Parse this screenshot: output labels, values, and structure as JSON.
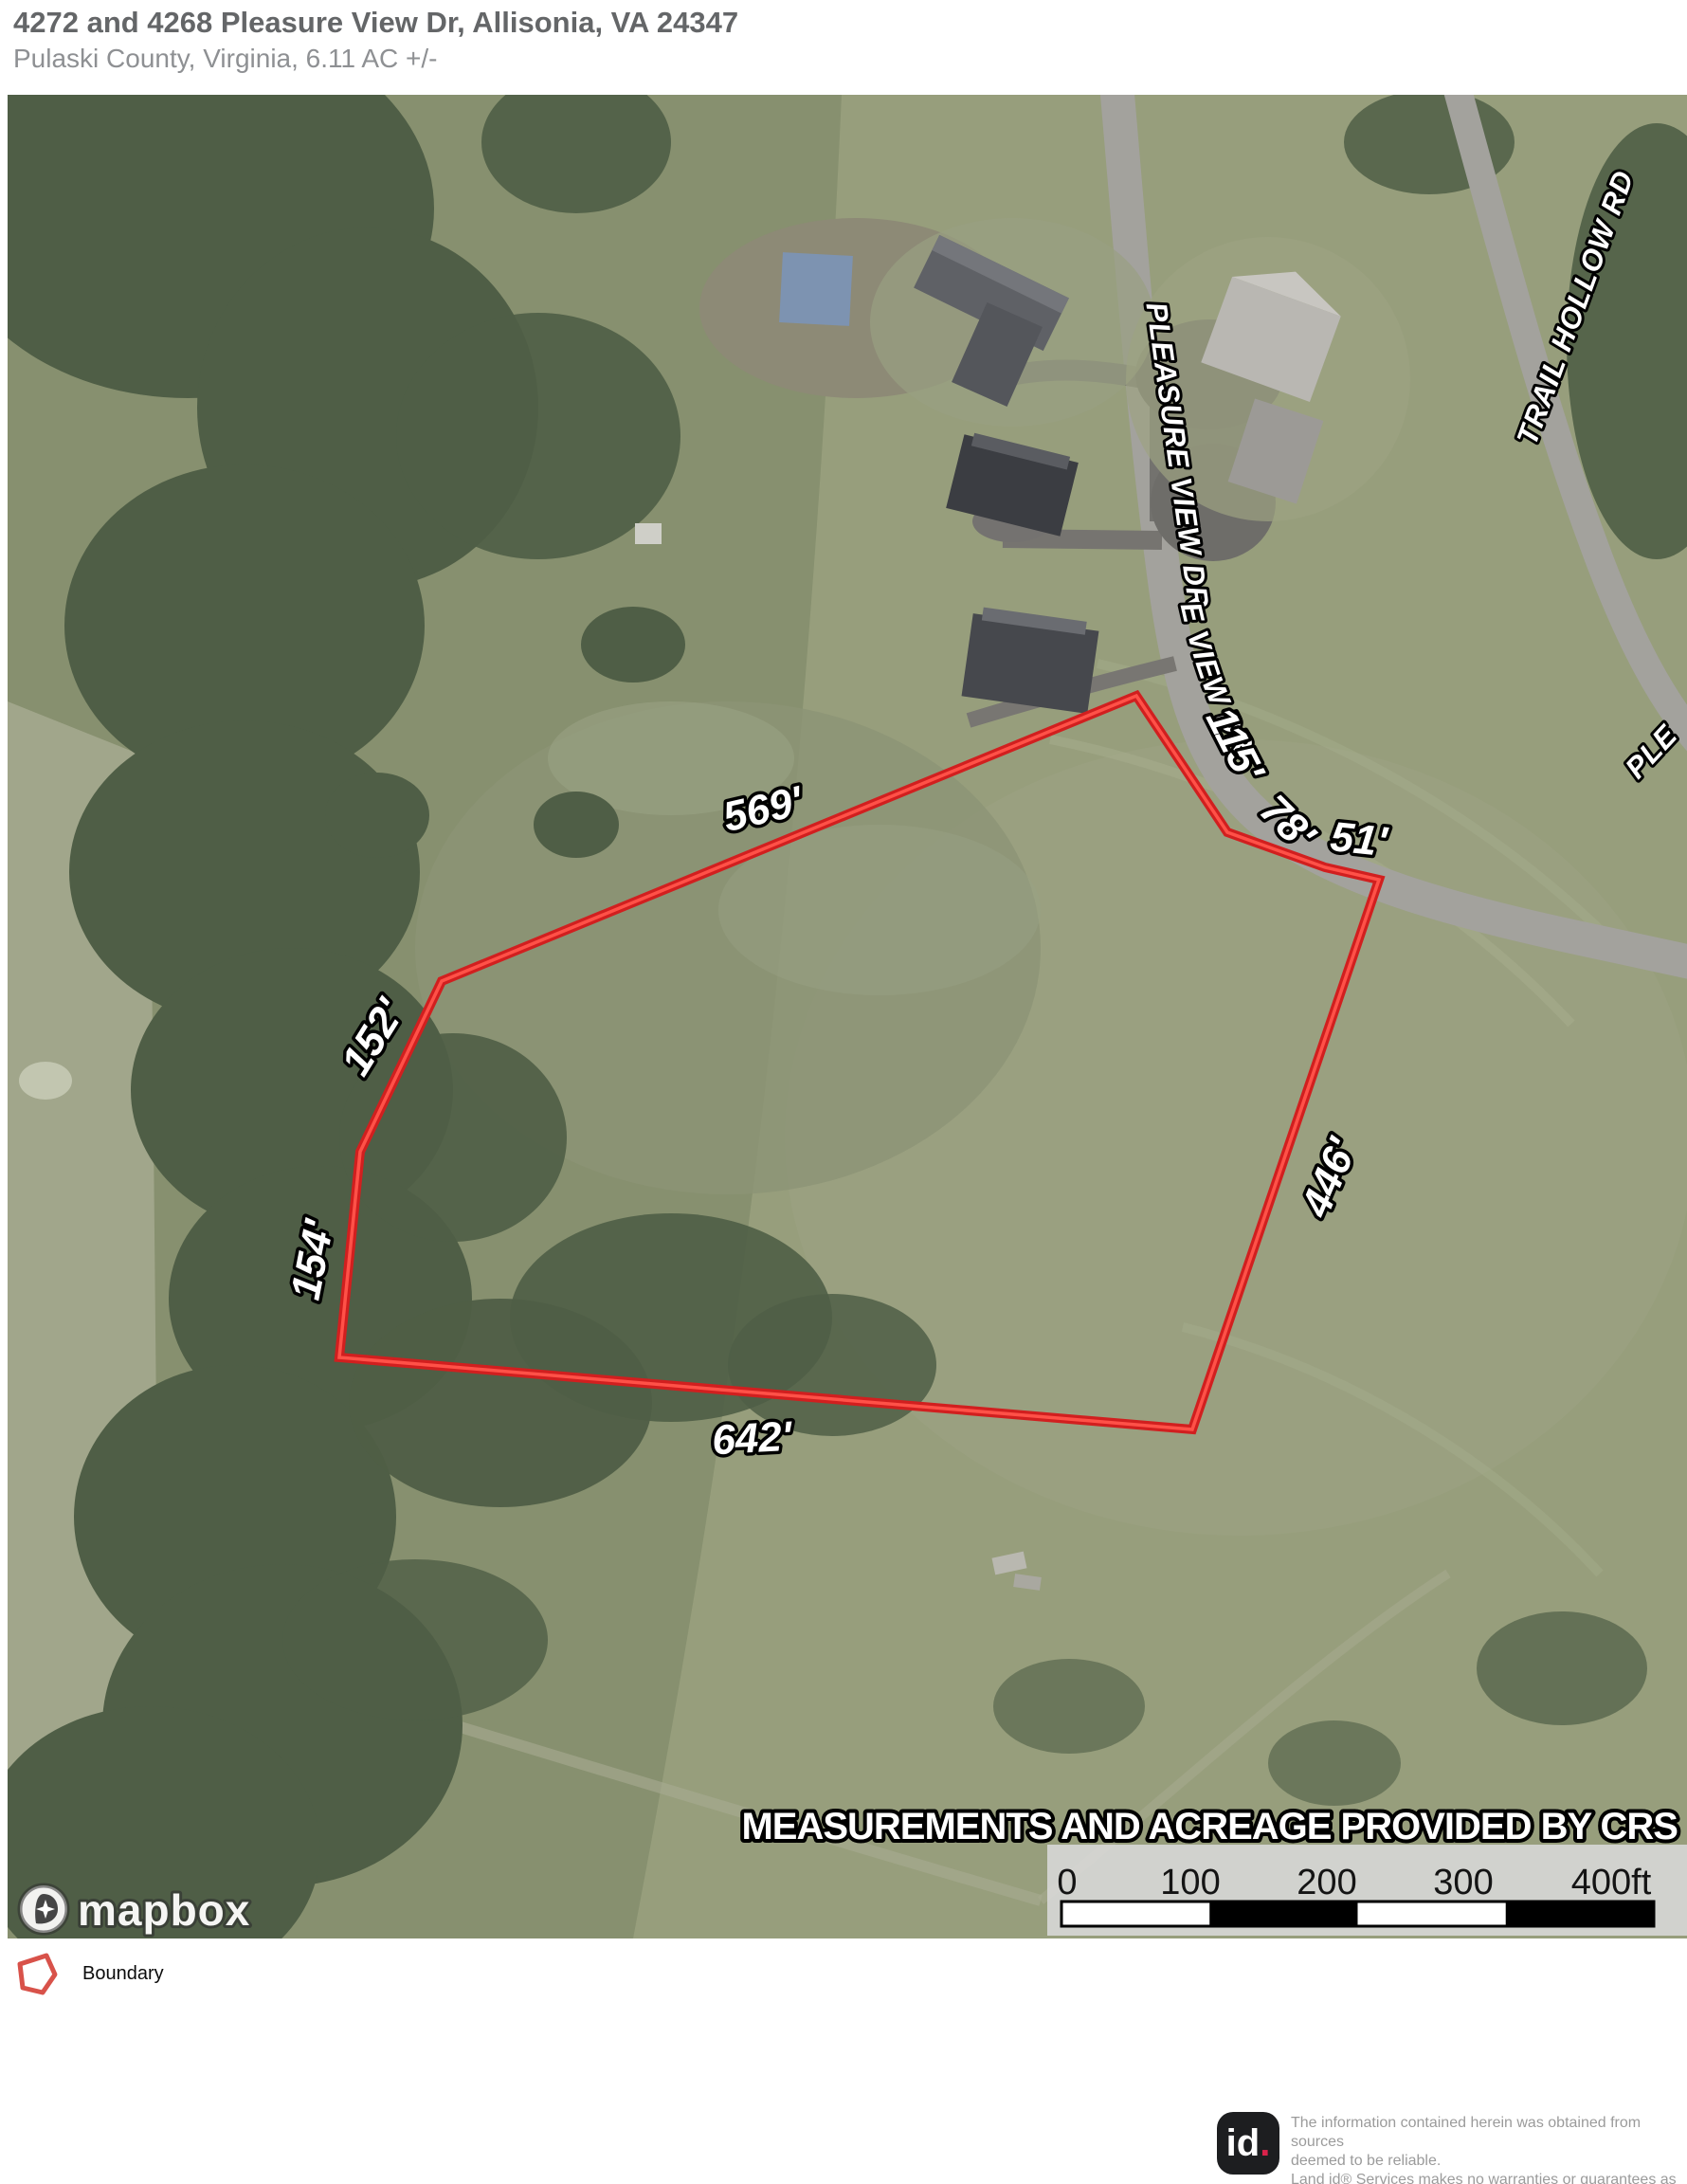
{
  "header": {
    "title": "4272 and 4268 Pleasure View Dr, Allisonia, VA 24347",
    "subtitle": "Pulaski County, Virginia, 6.11 AC +/-"
  },
  "map": {
    "banner": "MEASUREMENTS AND ACREAGE PROVIDED BY CRS",
    "attribution": "mapbox",
    "roads": {
      "pleasure_view_main": "PLEASURE VIEW DR",
      "pleasure_view_curve": "PLEASURE VIEW DR",
      "trail_hollow": "TRAIL HOLLOW RD",
      "pleasure_view_partial": "PLE"
    },
    "measurements": {
      "north": "569'",
      "west_upper": "152'",
      "west_lower": "154'",
      "south": "642'",
      "east": "446'",
      "road_seg_1": "115'",
      "road_seg_2": "78'",
      "road_seg_3": "51'"
    },
    "scale_bar": {
      "t0": "0",
      "t1": "100",
      "t2": "200",
      "t3": "300",
      "t4": "400ft"
    },
    "colors": {
      "boundary": "#d11f1f",
      "boundary_core": "#ff5148"
    }
  },
  "legend": {
    "boundary": "Boundary"
  },
  "footer": {
    "logo_id": "id",
    "logo_dot": ".",
    "line1": "The information contained herein was obtained from sources",
    "line2": "deemed to be reliable.",
    "line3": "Land id® Services makes no warranties or guarantees as to the",
    "line4": "completeness or accuracy thereof."
  }
}
